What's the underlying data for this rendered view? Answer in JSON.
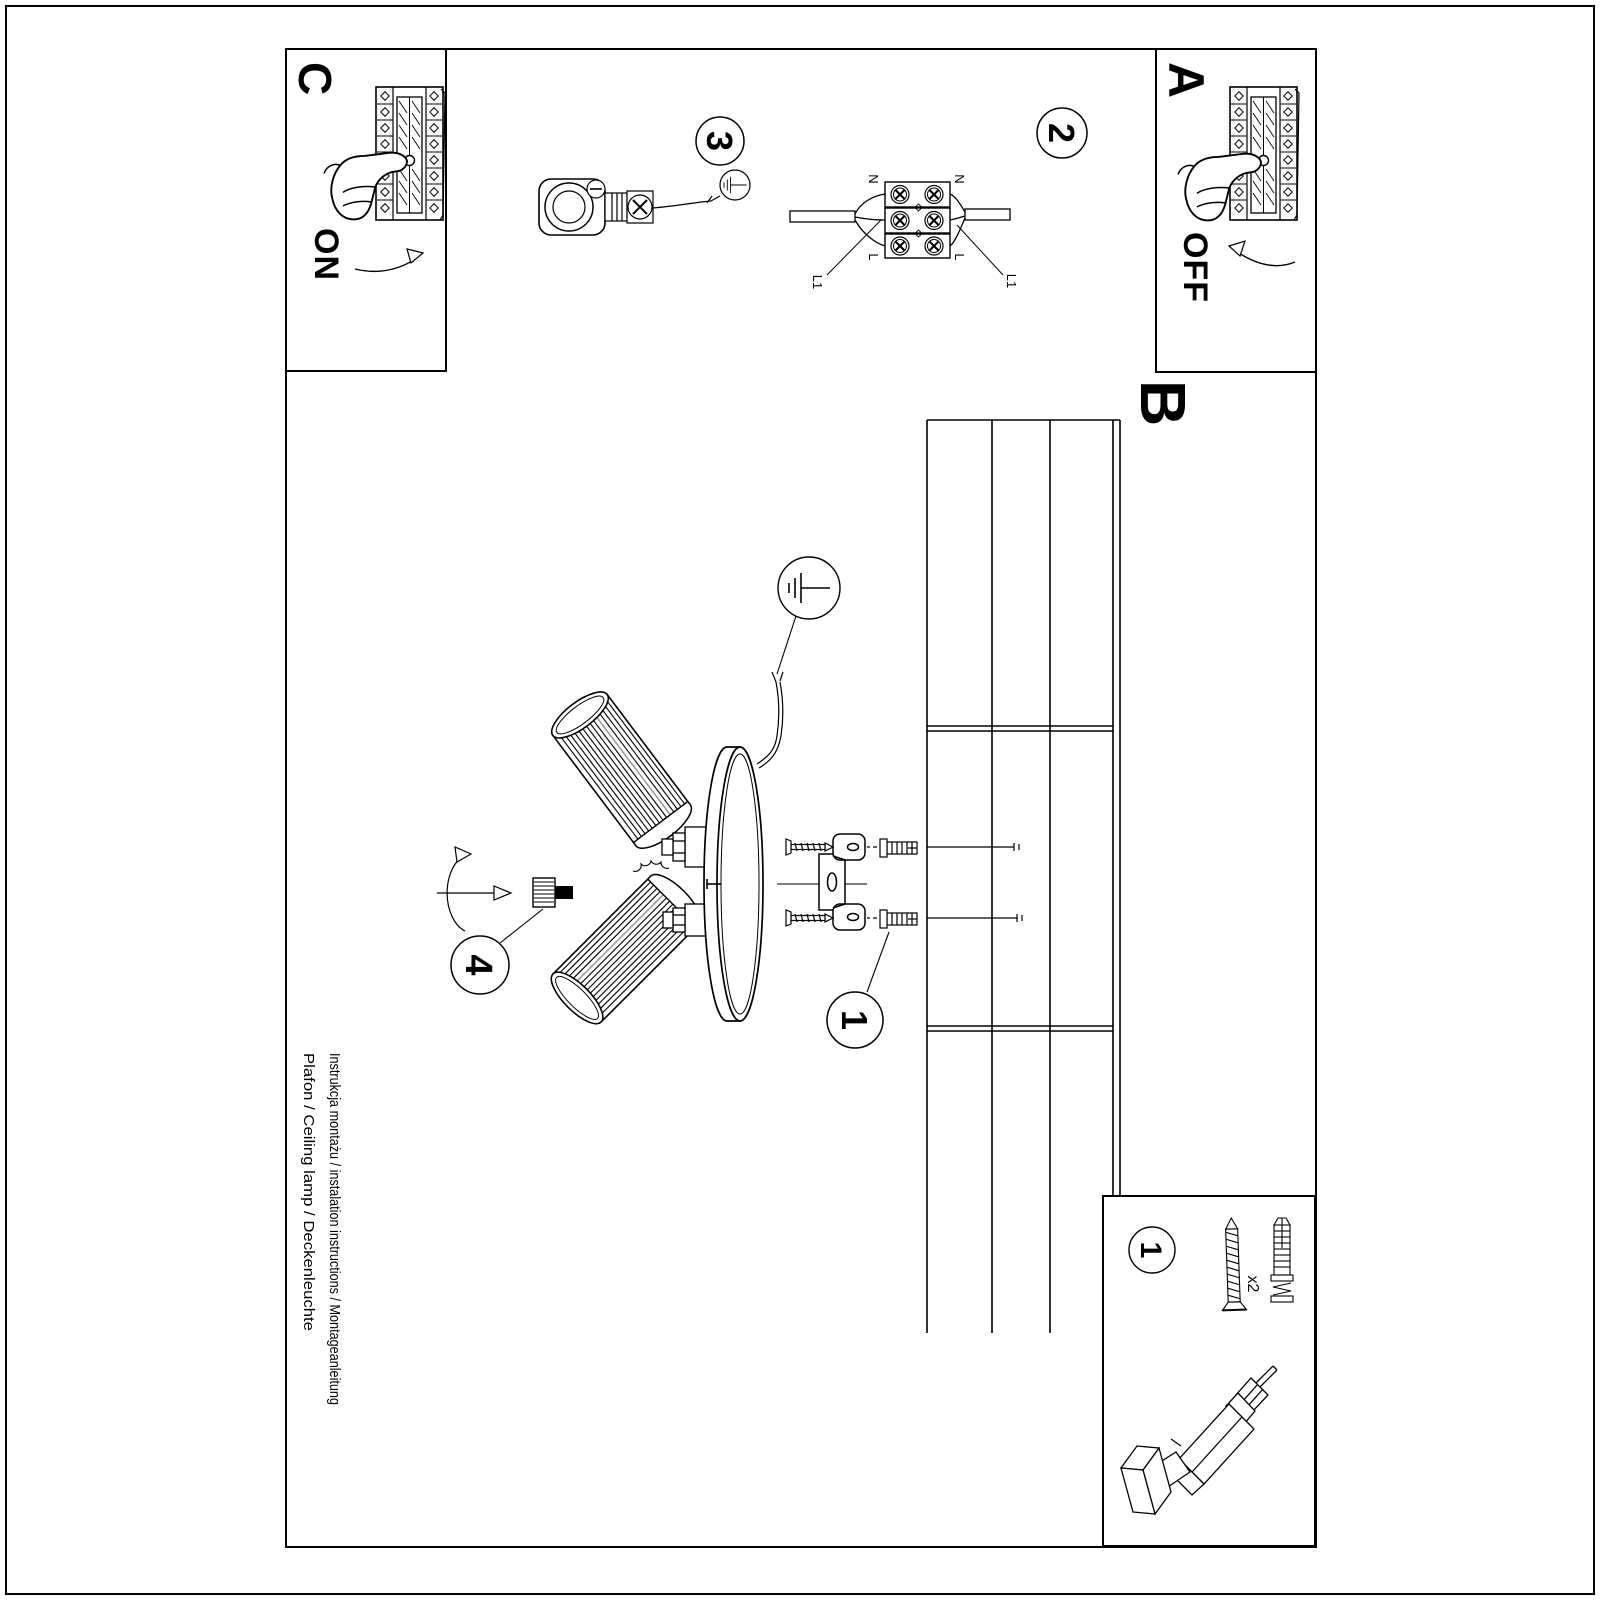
{
  "document": {
    "sections": {
      "a": "A",
      "b": "B",
      "c": "C"
    },
    "switch": {
      "on": "ON",
      "off": "OFF"
    },
    "steps": {
      "s1": "1",
      "s2": "2",
      "s3": "3",
      "s4": "4"
    },
    "wiring_labels": {
      "neutral": "N",
      "live": "L",
      "switched": "L1"
    },
    "parts": {
      "screw_qty": "x2"
    },
    "footer": {
      "line1": "Instrukcja montażu / instalation instructions / Montageanleitung",
      "line2": "Plafon / Ceiling lamp / Deckenleuchte"
    },
    "colors": {
      "line": "#000000",
      "paper": "#ffffff"
    }
  }
}
